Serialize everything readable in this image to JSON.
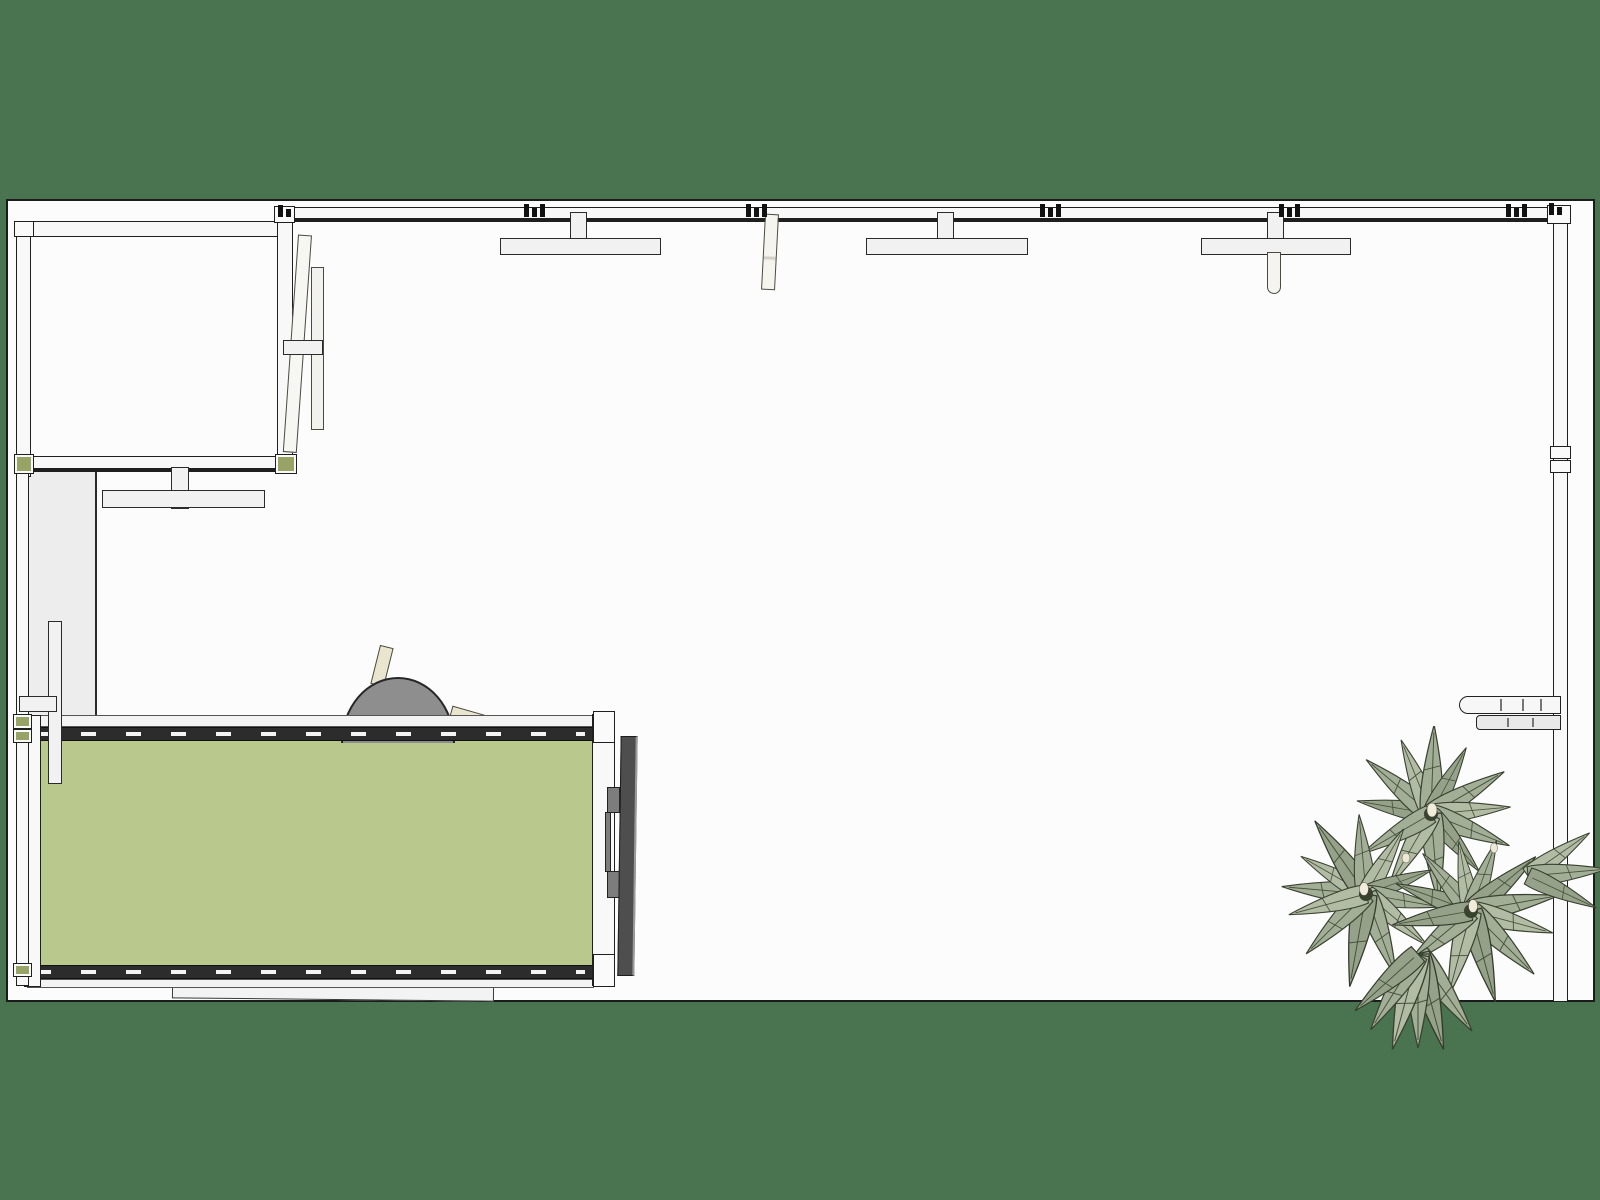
{
  "scene": {
    "app_type": "3d-model-top-view-render",
    "view": "top-down orthographic room plan",
    "objects": [
      {
        "name": "perimeter-wall",
        "desc": "outer wall running along top edge and right edge"
      },
      {
        "name": "entry-room",
        "desc": "small square room in top-left corner"
      },
      {
        "name": "pivot-door",
        "desc": "two tilted door leaves with crossbar beside entry room"
      },
      {
        "name": "corridor",
        "desc": "narrow passage below entry room"
      },
      {
        "name": "ceiling-panel-fixture",
        "count": 4,
        "desc": "T-shaped wall-mounted panels"
      },
      {
        "name": "open-door-leaf",
        "count": 2,
        "desc": "thin leaves hanging from top wall"
      },
      {
        "name": "green-living-wall",
        "desc": "freestanding green wall with dashed track rails and end posts"
      },
      {
        "name": "mounted-screen",
        "desc": "dark panel mounted on right end of living wall"
      },
      {
        "name": "dome-chair",
        "desc": "grey dome object behind living wall top rail"
      },
      {
        "name": "wall-shelf",
        "desc": "two slat shelf attached to right wall"
      },
      {
        "name": "floor-board",
        "desc": "flat panel lying below living wall"
      },
      {
        "name": "agave-plant",
        "desc": "spiky sage-green plant cluster in bottom-right corner"
      }
    ]
  },
  "colors": {
    "background": "#4a7350",
    "floor": "#fcfcfc",
    "outline": "#1c1c1c",
    "wall_fill": "#f8f8f8",
    "corridor": "#ededed",
    "leaf_wall_green": "#b9c98e",
    "rail_dark": "#2c2c2c",
    "accent_olive": "#97a465",
    "dome_gray": "#8e8e8e",
    "tv_dark": "#4e4e4e",
    "blade_beige": "#e9e5cf",
    "plant_leaf": "#a3ae97",
    "plant_leaf_dark": "#95a289",
    "plant_leaf_light": "#b2bba4"
  }
}
